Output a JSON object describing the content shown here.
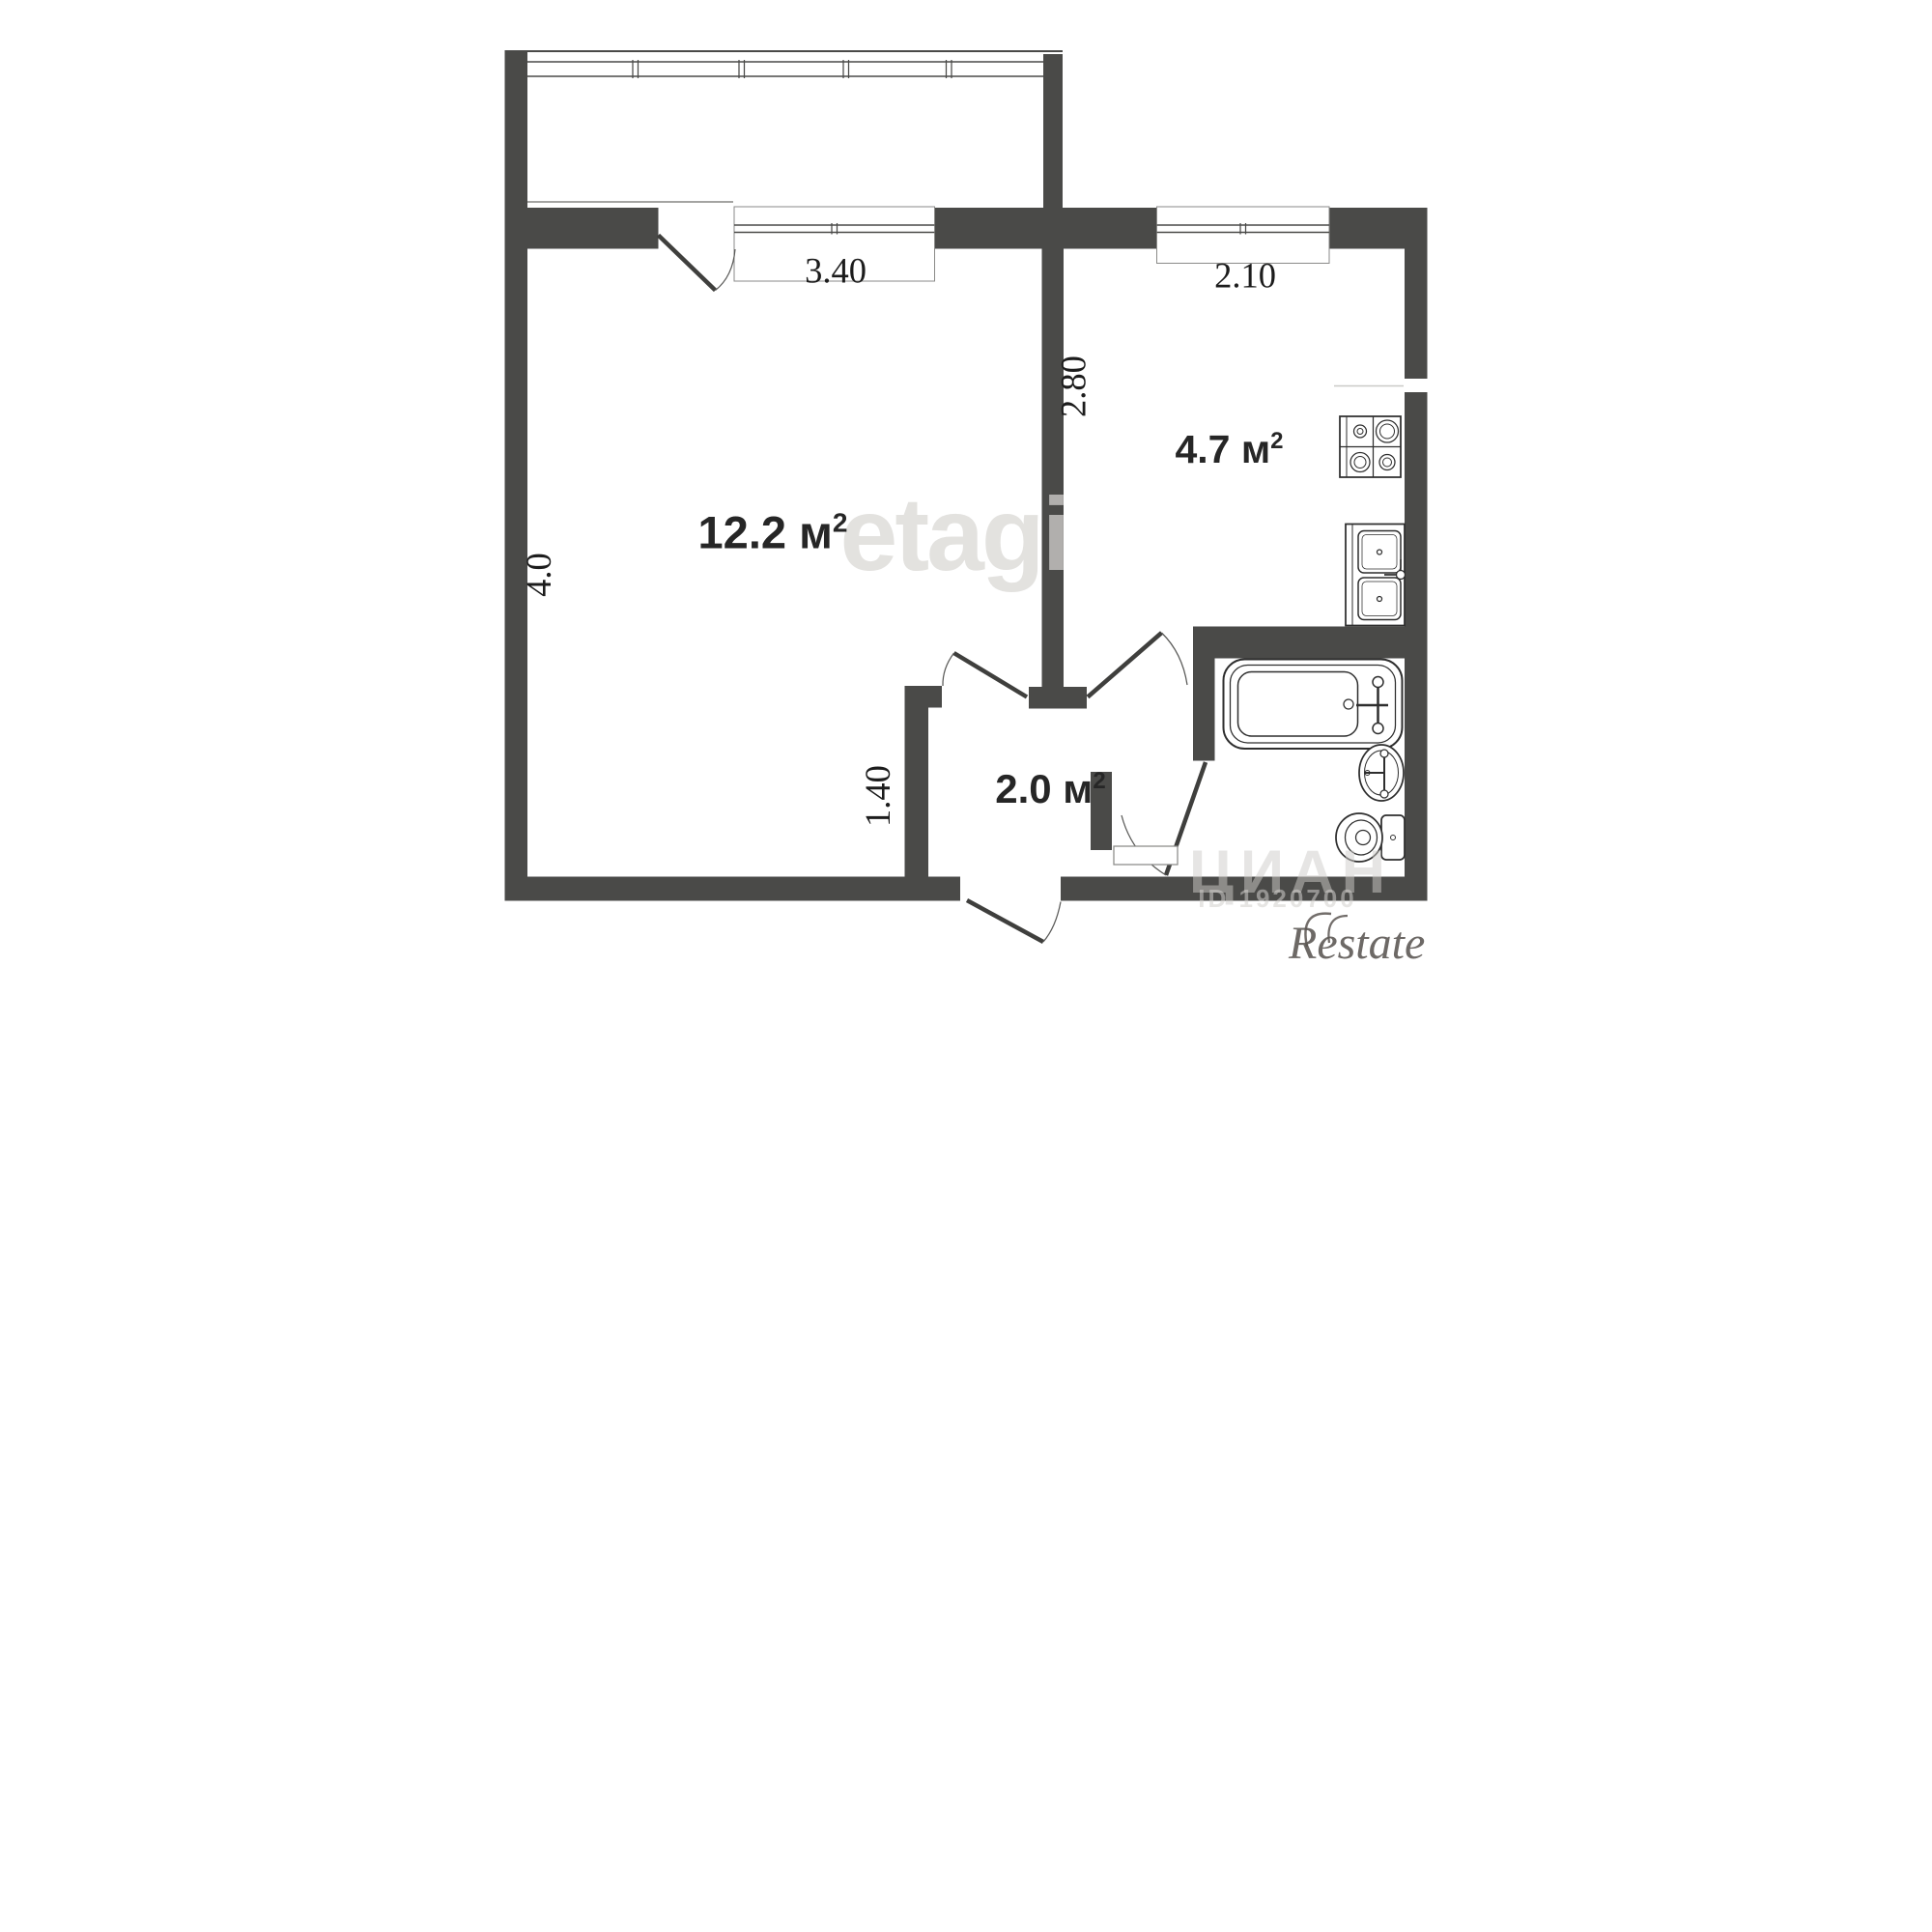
{
  "plan": {
    "type": "apartment-floor-plan",
    "rooms": [
      {
        "id": "living-room",
        "area_value": "12.2 м",
        "area_sup": "2"
      },
      {
        "id": "kitchen",
        "area_value": "4.7 м",
        "area_sup": "2"
      },
      {
        "id": "hallway",
        "area_value": "2.0 м",
        "area_sup": "2"
      }
    ],
    "dimensions": {
      "living_window_width": "3.40",
      "kitchen_window_width": "2.10",
      "kitchen_wall_height": "2.80",
      "living_wall_height": "4.0",
      "hallway_width": "1.40"
    },
    "fixtures": [
      "bathtub",
      "wash-basin",
      "toilet",
      "stove-4-burner",
      "double-kitchen-sink",
      "balcony-glazing"
    ],
    "watermarks": {
      "center_logo": "etagi",
      "listing_site": "ЦИАН",
      "listing_id": "ID 1920700",
      "brand_logo": "Restate"
    },
    "colors": {
      "wall": "#4a4a48",
      "fixture_line": "#2e2e2e",
      "label_text": "#1c1c1c",
      "watermark": "#d9d7d4",
      "brand": "#5a5551",
      "background": "#ffffff"
    }
  }
}
